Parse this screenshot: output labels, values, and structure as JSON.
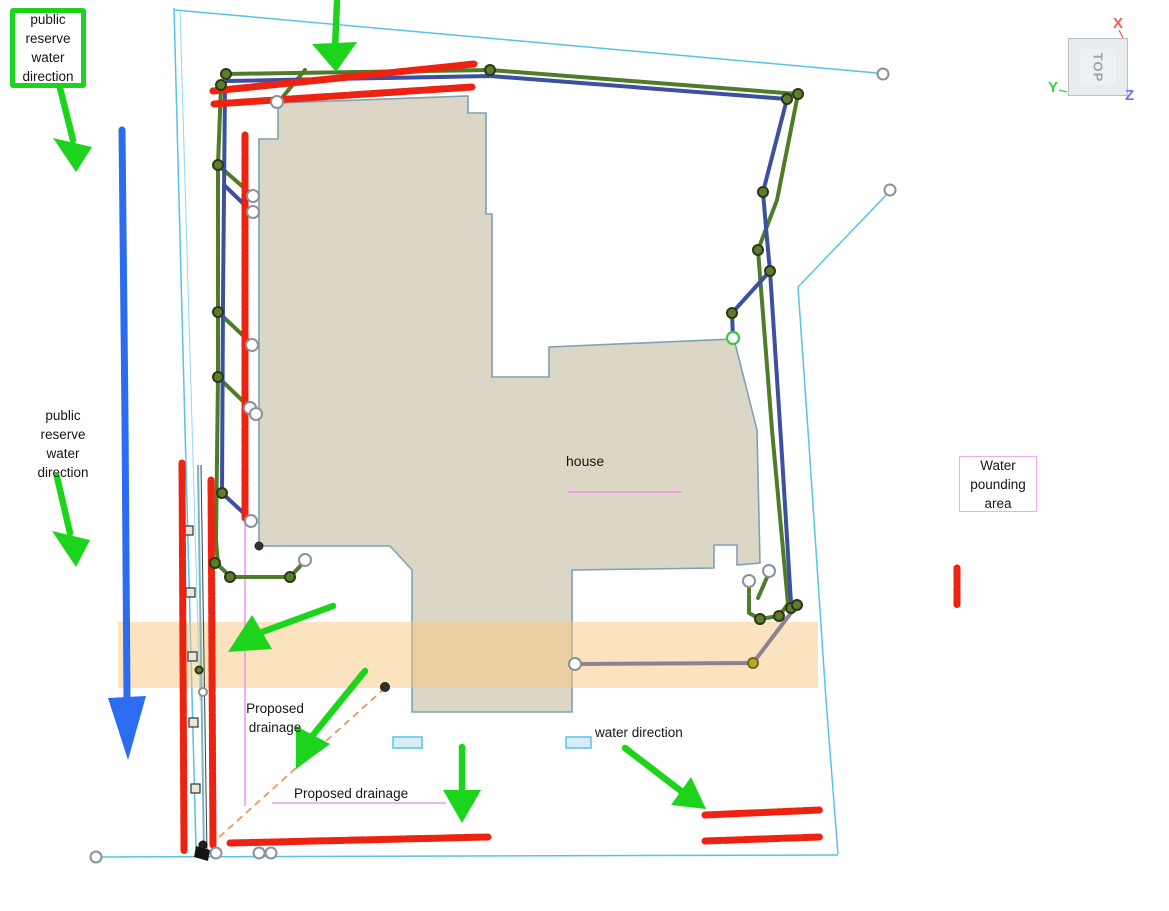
{
  "labels": {
    "public_reserve_top": "public\nreserve\nwater\ndirection",
    "public_reserve_mid": "public\nreserve\nwater\ndirection",
    "house": "house",
    "water_pounding_area": "Water\npounding\narea",
    "proposed_drainage_left": "Proposed\ndrainage",
    "proposed_drainage_bottom": "Proposed drainage",
    "water_direction": "water direction"
  },
  "viewcube": {
    "face": "TOP",
    "axis_x": "X",
    "axis_y": "Y",
    "axis_z": "Z"
  },
  "colors": {
    "annotation_green": "#1bd41b",
    "annotation_blue": "#2b6cf0",
    "marker_red": "#ee2211",
    "pipe_green": "#4e7c28",
    "pipe_blue": "#3d4fa0",
    "pipe_taupe": "#8d8292",
    "boundary_cyan": "#56c3e8",
    "house_fill": "#dcd6c7",
    "house_stroke": "#7da2b2",
    "band_orange": "#f5c87d",
    "pink_line": "#ec86e8",
    "dashed_orange": "#e89a5e",
    "axis_x_red": "#f25c5c",
    "axis_y_green": "#37d437",
    "axis_z_violet": "#7a6cf2"
  }
}
